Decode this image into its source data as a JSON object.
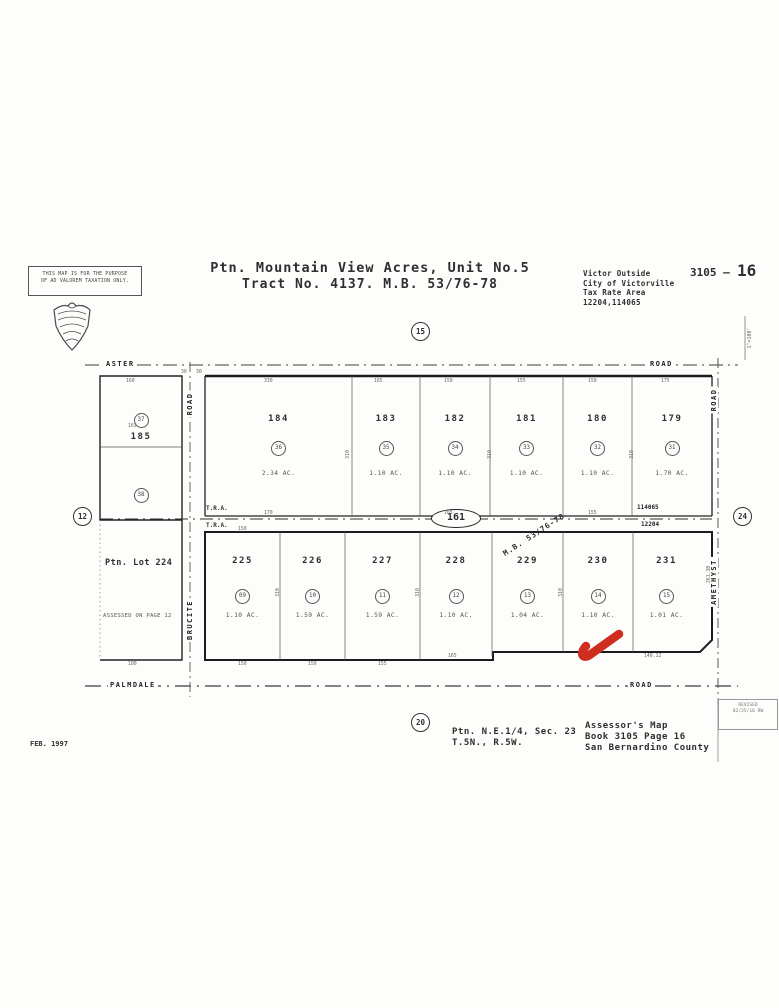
{
  "header": {
    "disclaimer_line1": "THIS MAP IS FOR THE PURPOSE",
    "disclaimer_line2": "OF AD VALOREM TAXATION ONLY.",
    "title_line1": "Ptn. Mountain View Acres, Unit No.5",
    "title_line2": "Tract No. 4137. M.B. 53/76-78",
    "sheet_prefix": "3105 –",
    "sheet_number": "16",
    "tax_line1": "Victor Outside",
    "tax_line2": "City of Victorville",
    "tax_line3": "Tax Rate Area",
    "tax_line4": "12204,114065",
    "scale_note": "1\"=100'"
  },
  "map": {
    "section_markers": {
      "top": "15",
      "bottom": "20",
      "left": "12",
      "right": "24"
    },
    "roads": {
      "top_left": "ASTER",
      "top_right": "ROAD",
      "bottom_left": "PALMDALE",
      "bottom_right": "ROAD",
      "west_vertical_top": "ROAD",
      "west_vertical": "BRUCITE",
      "east_vertical": "AMETHYST",
      "east_vertical_top": "ROAD"
    },
    "center_lot": "161",
    "mb_ref": "M.B. 53/76-78",
    "tra_label": "T.R.A.",
    "tra_right_top": "114065",
    "tra_right_bottom": "12204",
    "left_block": {
      "lot": "185",
      "pin_top": "37",
      "pin_bottom": "38"
    },
    "left_bottom_block": {
      "label": "Ptn. Lot 224",
      "note": "ASSESSED ON PAGE 12"
    },
    "top_row": [
      {
        "lot": "184",
        "pin": "36",
        "area": "2.34 AC."
      },
      {
        "lot": "183",
        "pin": "35",
        "area": "1.10 AC."
      },
      {
        "lot": "182",
        "pin": "34",
        "area": "1.10 AC."
      },
      {
        "lot": "181",
        "pin": "33",
        "area": "1.10 AC."
      },
      {
        "lot": "180",
        "pin": "32",
        "area": "1.10 AC."
      },
      {
        "lot": "179",
        "pin": "31",
        "area": "1.70 AC."
      }
    ],
    "bottom_row": [
      {
        "lot": "225",
        "pin": "09",
        "area": "1.10 AC."
      },
      {
        "lot": "226",
        "pin": "10",
        "area": "1.59 AC."
      },
      {
        "lot": "227",
        "pin": "11",
        "area": "1.59 AC."
      },
      {
        "lot": "228",
        "pin": "12",
        "area": "1.10 AC."
      },
      {
        "lot": "229",
        "pin": "13",
        "area": "1.04 AC."
      },
      {
        "lot": "230",
        "pin": "14",
        "area": "1.10 AC."
      },
      {
        "lot": "231",
        "pin": "15",
        "area": "1.01 AC."
      }
    ],
    "dims": [
      {
        "t": "160",
        "x": 126,
        "y": 379
      },
      {
        "t": "330",
        "x": 264,
        "y": 379
      },
      {
        "t": "165",
        "x": 374,
        "y": 379
      },
      {
        "t": "150",
        "x": 444,
        "y": 379
      },
      {
        "t": "155",
        "x": 517,
        "y": 379
      },
      {
        "t": "150",
        "x": 588,
        "y": 379
      },
      {
        "t": "175",
        "x": 661,
        "y": 379
      },
      {
        "t": "30",
        "x": 181,
        "y": 370
      },
      {
        "t": "30",
        "x": 196,
        "y": 370
      },
      {
        "t": "163",
        "x": 128,
        "y": 424
      },
      {
        "t": "310",
        "x": 344,
        "y": 452,
        "r": -90
      },
      {
        "t": "310",
        "x": 486,
        "y": 452,
        "r": -90
      },
      {
        "t": "310",
        "x": 628,
        "y": 452,
        "r": -90
      },
      {
        "t": "170",
        "x": 264,
        "y": 511
      },
      {
        "t": "165",
        "x": 444,
        "y": 511
      },
      {
        "t": "155",
        "x": 588,
        "y": 511
      },
      {
        "t": "150",
        "x": 238,
        "y": 527
      },
      {
        "t": "310",
        "x": 274,
        "y": 590,
        "r": -90
      },
      {
        "t": "310",
        "x": 414,
        "y": 590,
        "r": -90
      },
      {
        "t": "310",
        "x": 557,
        "y": 590,
        "r": -90
      },
      {
        "t": "261.38",
        "x": 701,
        "y": 572,
        "r": -90
      },
      {
        "t": "150",
        "x": 238,
        "y": 662
      },
      {
        "t": "150",
        "x": 308,
        "y": 662
      },
      {
        "t": "155",
        "x": 378,
        "y": 662
      },
      {
        "t": "165",
        "x": 448,
        "y": 654
      },
      {
        "t": "140.12",
        "x": 644,
        "y": 654
      },
      {
        "t": "100",
        "x": 128,
        "y": 662
      }
    ]
  },
  "footer": {
    "section_ref1": "Ptn. N.E.1/4, Sec. 23",
    "section_ref2": "T.5N., R.5W.",
    "assessor_line1": "Assessor's Map",
    "assessor_line2": "Book 3105 Page 16",
    "assessor_line3": "San Bernardino County",
    "date": "FEB. 1997",
    "revision_line1": "REVISED",
    "revision_line2": "02/25/16 RW"
  },
  "colors": {
    "highlight": "#cf2d1f",
    "ink": "#2e2e2e"
  }
}
